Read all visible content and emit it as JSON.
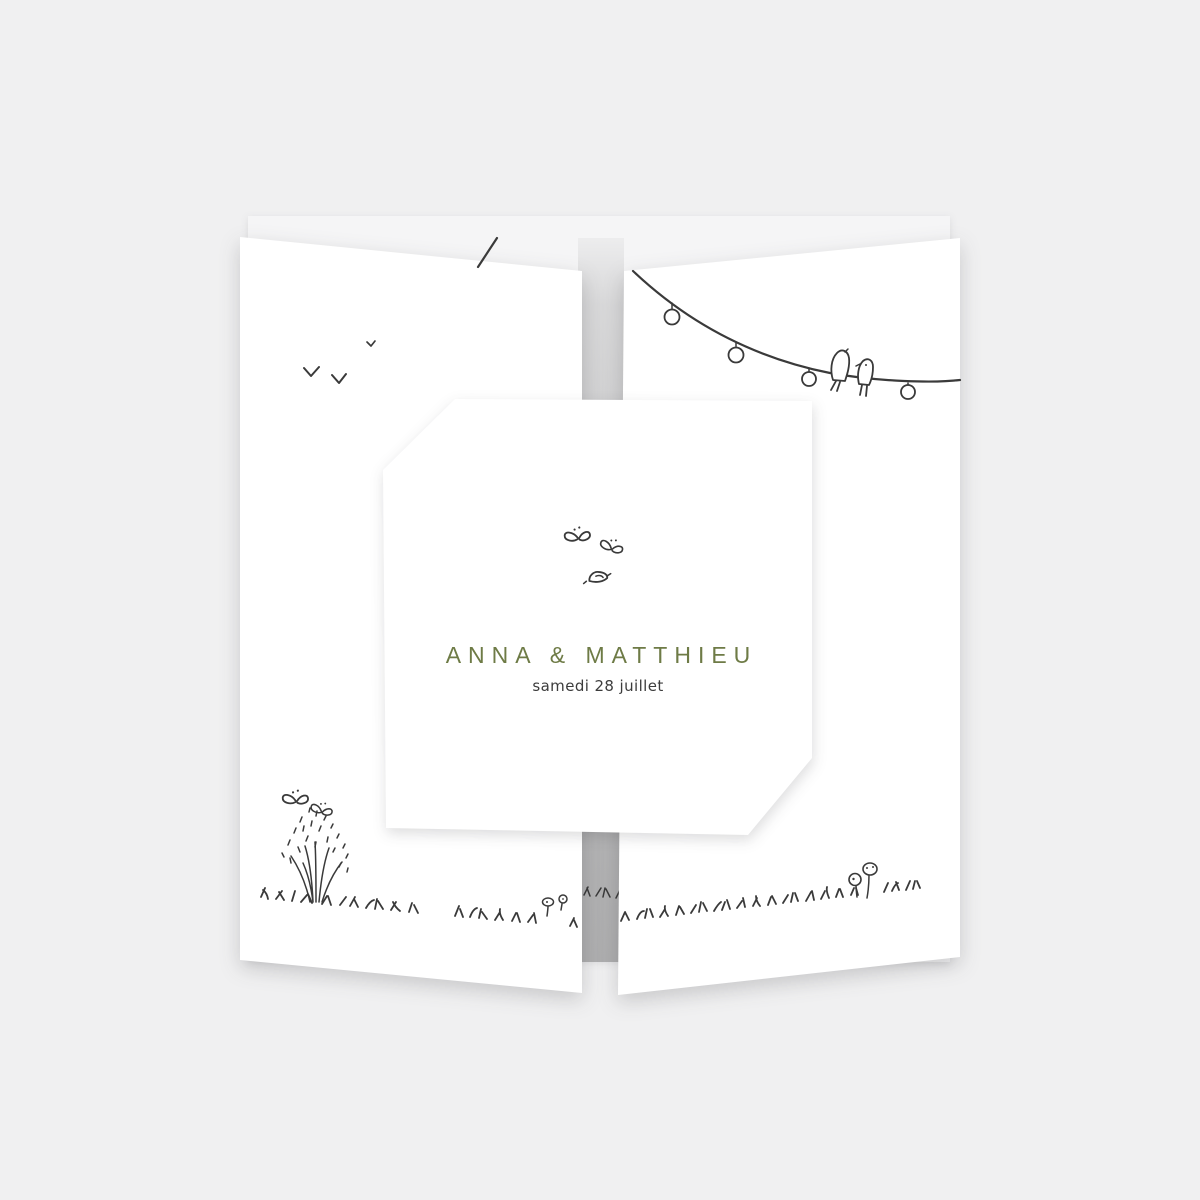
{
  "card": {
    "couple_names": "ANNA & MATTHIEU",
    "event_date": "samedi 28 juillet",
    "names_color": "#6E7B46",
    "date_color": "#3C3C3C"
  },
  "colors": {
    "background": "#F0F0F1",
    "panel": "#FFFFFF",
    "back_panel": "#F5F5F6",
    "gap_strip_top": "#E4E4E5",
    "gap_strip_bottom": "#B1B1B2",
    "ink": "#3A3A3A"
  },
  "illustrations": {
    "flying_birds": "flying birds doodle",
    "butterflies_left": "butterflies doodle",
    "wildflower": "wildflower doodle",
    "grass_left": "grass doodle",
    "small_flowers": "small flowers doodle",
    "grass_strip": "grass doodle on gap strip",
    "garland_stub": "string light wire continuation",
    "string_lights": "string lights doodle",
    "perched_birds": "perched birds doodle",
    "grass_right": "grass doodle",
    "mushrooms": "mushrooms doodle",
    "butterflies_card": "butterflies doodle",
    "bird_card": "bird doodle"
  }
}
